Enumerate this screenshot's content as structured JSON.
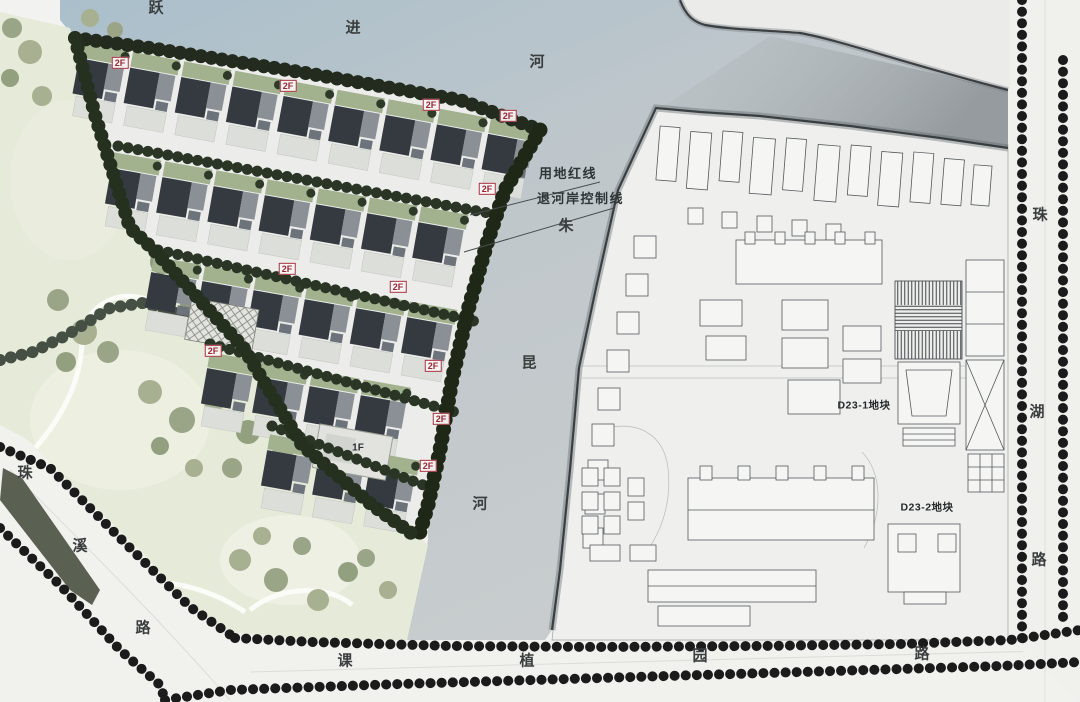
{
  "map": {
    "rivers": {
      "yuejin": {
        "name": "跃进河",
        "chars": [
          "跃",
          "进",
          "河"
        ]
      },
      "zhukun": {
        "name": "朱昆河",
        "chars": [
          "朱",
          "昆",
          "河"
        ]
      }
    },
    "roads": {
      "zhuxi": {
        "name": "珠溪路",
        "chars": [
          "珠",
          "溪",
          "路"
        ]
      },
      "zhuhu": {
        "name": "珠湖路",
        "chars": [
          "珠",
          "湖",
          "路"
        ]
      },
      "kezhiyuan": {
        "name": "课植园路",
        "chars": [
          "课",
          "植",
          "园",
          "路"
        ]
      }
    },
    "annotations": {
      "land_red_line": "用地红线",
      "riverbank_setback_line": "退河岸控制线"
    },
    "parcels": {
      "d23_1": "D23-1地块",
      "d23_2": "D23-2地块"
    },
    "floor_labels": {
      "two_story": "2F",
      "one_story": "1F"
    },
    "colors": {
      "water": "#b7c3cb",
      "park": "#e6ead9",
      "site_left": "#ecedea",
      "site_right": "#eff0ee",
      "street_tree": "#1b1b1b",
      "site_tree": "#222b1d",
      "roof_dark": "#34393f",
      "floor_label_red": "#9c2736",
      "road": "#f1f1ee"
    }
  }
}
